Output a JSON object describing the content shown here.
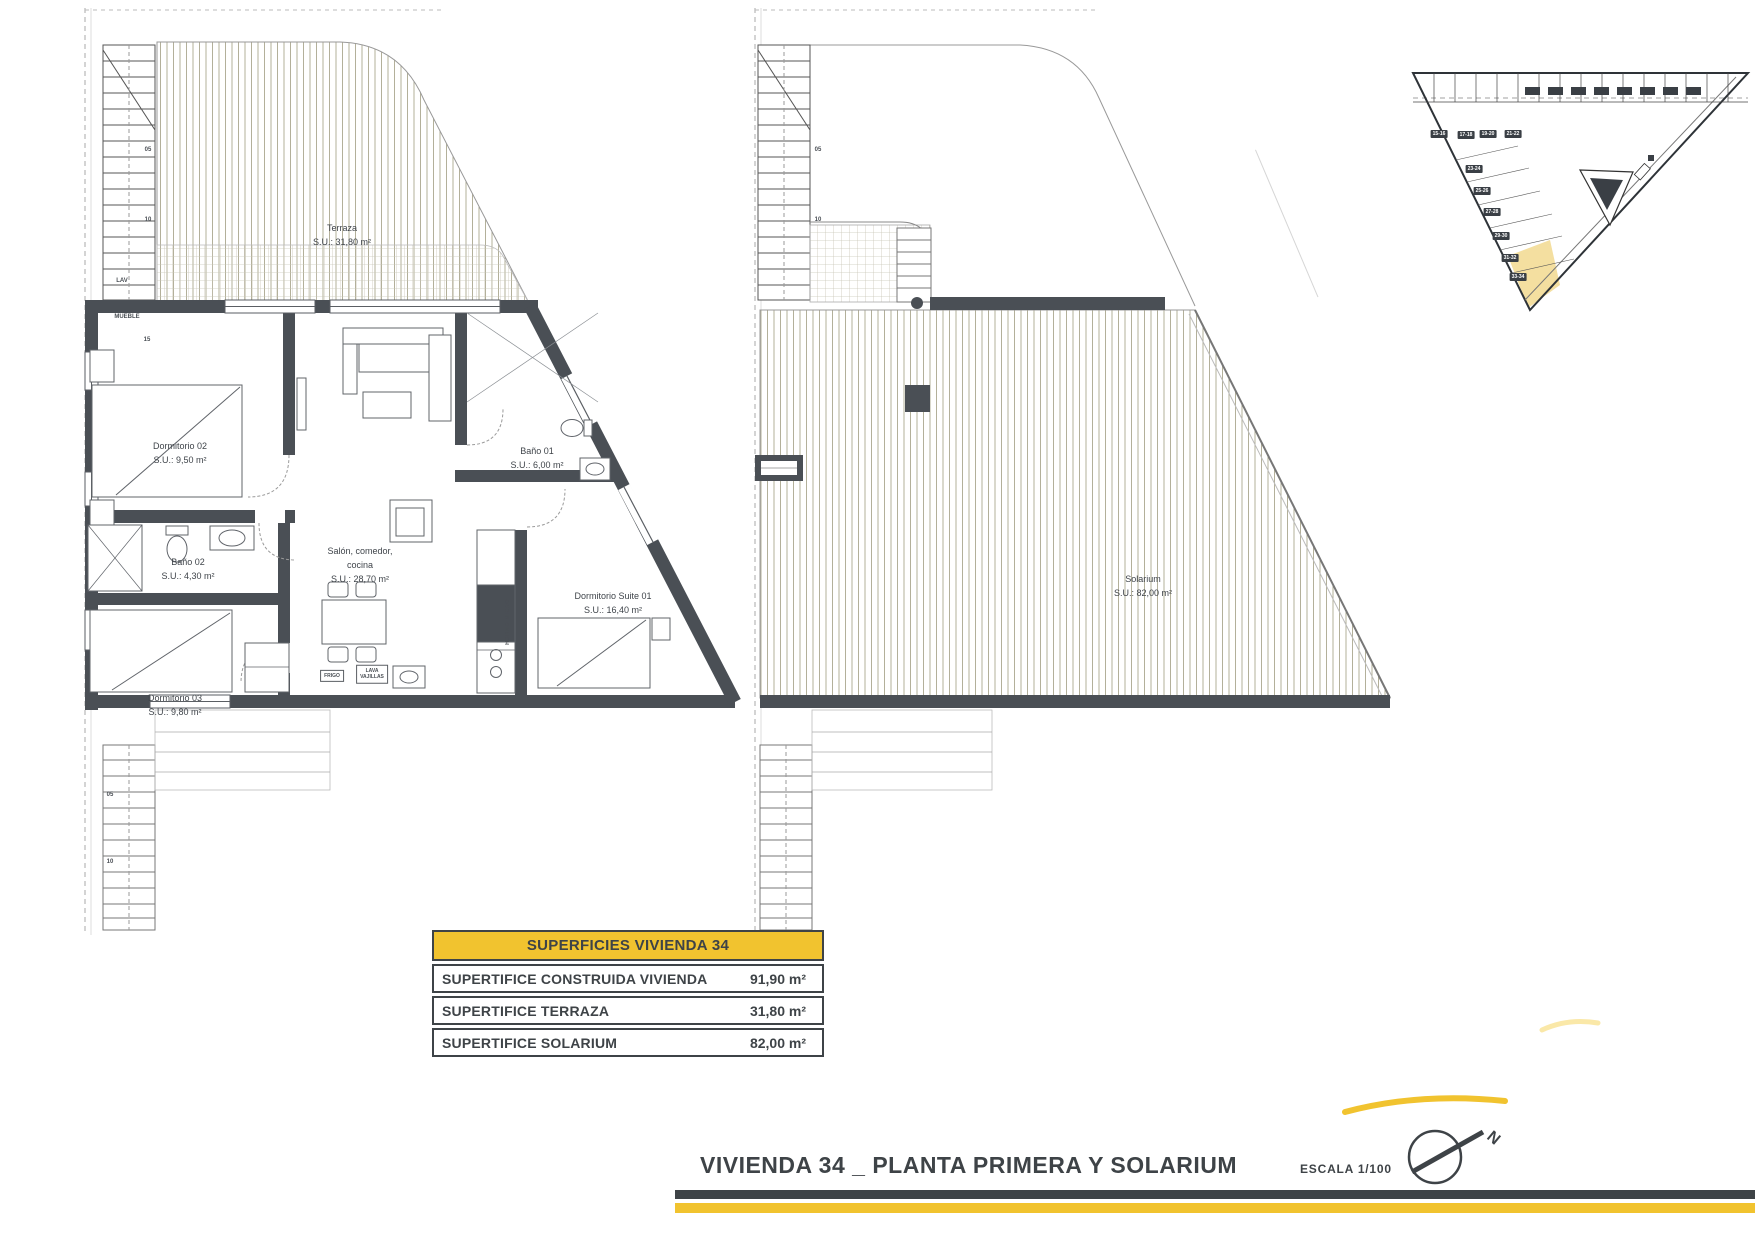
{
  "document": {
    "title": "VIVIENDA 34 _ PLANTA PRIMERA Y SOLARIUM",
    "scale": "ESCALA 1/100",
    "north_letter": "N",
    "accent_yellow": "#F1C32F",
    "wall_color": "#4A4F55",
    "highlight_color": "#F4DFA0"
  },
  "plans": {
    "first_floor": {
      "rooms": {
        "terraza": {
          "name": "Terraza",
          "area": "S.U.: 31,80 m²"
        },
        "dormitorio02": {
          "name": "Dormitorio 02",
          "area": "S.U.: 9,50 m²"
        },
        "bano01": {
          "name": "Baño 01",
          "area": "S.U.: 6,00 m²"
        },
        "bano02": {
          "name": "Baño 02",
          "area": "S.U.: 4,30 m²"
        },
        "salon": {
          "name": "Salón, comedor,",
          "name2": "cocina",
          "area": "S.U.: 28,70 m²"
        },
        "dormitorio03": {
          "name": "Dormitorio 03",
          "area": "S.U.: 9,80 m²"
        },
        "suite": {
          "name": "Dormitorio Suite 01",
          "area": "S.U.: 16,40 m²"
        }
      },
      "stair_labels": [
        "05",
        "10",
        "15"
      ],
      "lower_stair_labels": [
        "05",
        "10"
      ],
      "annotations": {
        "lav": "LAV",
        "mueble": "MUEBLE",
        "frigo": "FRIGO",
        "lava_line1": "LAVA",
        "lava_line2": "VAJILLAS",
        "horno": "HORNO MICRO"
      }
    },
    "solarium_floor": {
      "rooms": {
        "solarium": {
          "name": "Solarium",
          "area": "S.U.: 82,00 m²"
        }
      },
      "stair_labels": [
        "05",
        "10"
      ]
    }
  },
  "key_map": {
    "left_badges": [
      "15-16",
      "17-18",
      "19-20",
      "21-22"
    ],
    "diagonal_badges": [
      "23-24",
      "25-26",
      "27-28",
      "29-30",
      "31-32",
      "33-34"
    ],
    "highlighted_unit": "33-34"
  },
  "summary_table": {
    "header": "SUPERFICIES VIVIENDA 34",
    "rows": [
      {
        "label": "SUPERTIFICE CONSTRUIDA VIVIENDA",
        "value": "91,90 m²"
      },
      {
        "label": "SUPERTIFICE TERRAZA",
        "value": "31,80 m²"
      },
      {
        "label": "SUPERTIFICE SOLARIUM",
        "value": "82,00 m²"
      }
    ]
  }
}
